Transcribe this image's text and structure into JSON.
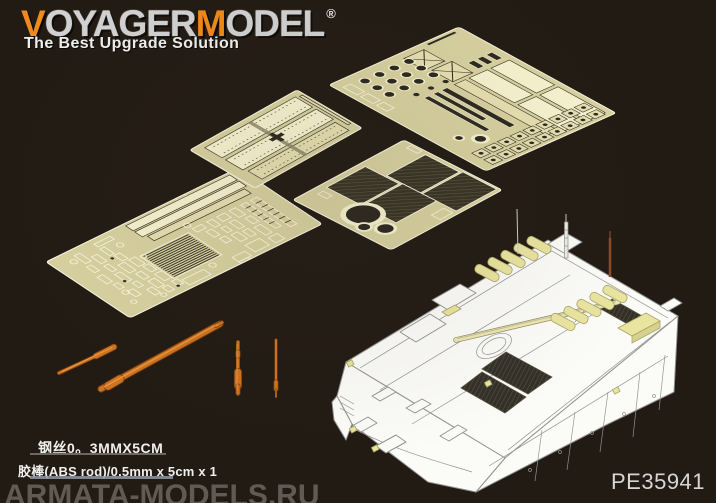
{
  "brand": {
    "logo": {
      "v": "V",
      "oyager": "OYAGER",
      "m": "M",
      "odel": "ODEL",
      "registered": "®"
    },
    "tagline": "The Best Upgrade Solution"
  },
  "product": {
    "code": "PE35941"
  },
  "specs": {
    "wire": "钢丝0。3MMX5CM",
    "abs_rod": "胶棒(ABS rod)/0.5mm x 5cm x 1"
  },
  "watermark": {
    "text": "ARMATA-MODELS.RU"
  },
  "objects": {
    "sheet_large": "photo-etch-fret-large",
    "sheet_mesh": "photo-etch-fret-mesh-grilles",
    "sheet_hatch": "photo-etch-fret-hatch-panels",
    "sheet_main": "photo-etch-fret-main",
    "rods": "brass-rods-and-antenna-parts",
    "vehicle": "armored-vehicle-line-drawing"
  },
  "colors": {
    "bg": "#221b14",
    "accent-orange": "#ef8a1c",
    "logo-silver": "#d2d2d2",
    "text-white": "#f0f0ee",
    "fret-base": "#d8d1a0",
    "fret-panel": "#f7f3cf",
    "fret-mid": "#e7e0b2",
    "fret-bright": "#fdf9e2",
    "etch-dark": "#2e2a20",
    "rod-orange": "#cf7420",
    "rod-dark": "#7c3f0e",
    "rod-light": "#f0a04e",
    "veh-white": "#fbfbf8",
    "veh-line": "#939393",
    "hl-yellow": "#e9e4a0",
    "hl-yellow-edge": "#a9a465",
    "watermark-gray": "#9b948d",
    "code-gray": "#d6d6d4",
    "underline-gray": "#6b6761",
    "underline-blue": "#8d98a8"
  }
}
